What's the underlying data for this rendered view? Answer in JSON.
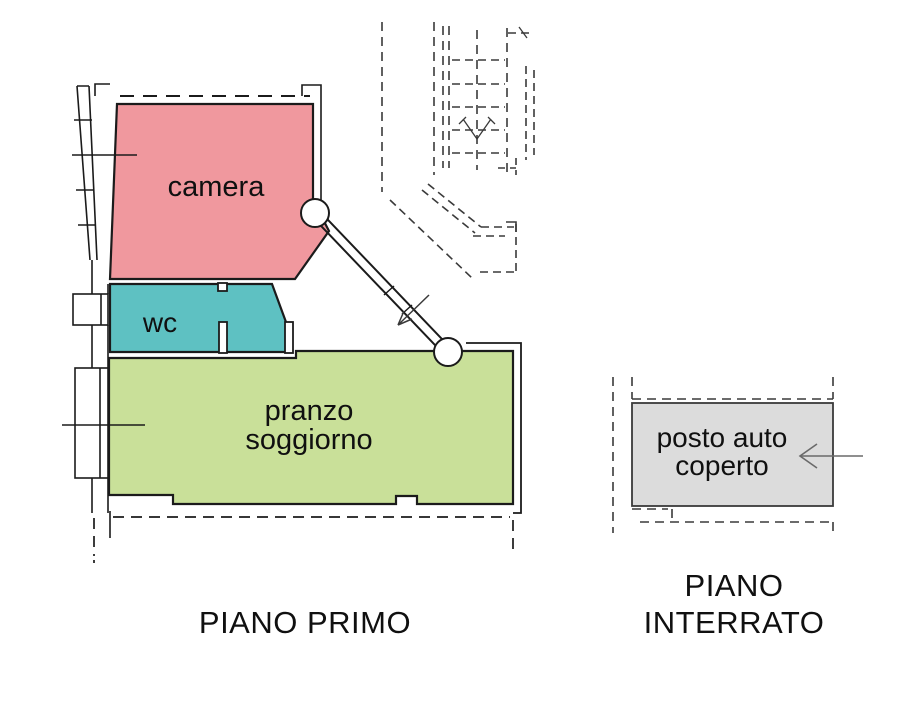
{
  "floor_plans": {
    "piano_primo": {
      "title": "PIANO PRIMO",
      "rooms": {
        "camera": {
          "label": "camera",
          "color": "#f0989e"
        },
        "wc": {
          "label": "wc",
          "color": "#5ec1c2"
        },
        "pranzo_soggiorno": {
          "label_line1": "pranzo",
          "label_line2": "soggiorno",
          "color": "#c9e099"
        }
      }
    },
    "piano_interrato": {
      "title_line1": "PIANO",
      "title_line2": "INTERRATO",
      "rooms": {
        "posto_auto": {
          "label_line1": "posto auto",
          "label_line2": "coperto",
          "color": "#dcdcdc"
        }
      }
    }
  },
  "colors": {
    "paper": "#ffffff",
    "wall": "#1b1b1b",
    "detail": "#3a3a3a",
    "gray_line": "#6a6a6a",
    "text": "#101010"
  }
}
